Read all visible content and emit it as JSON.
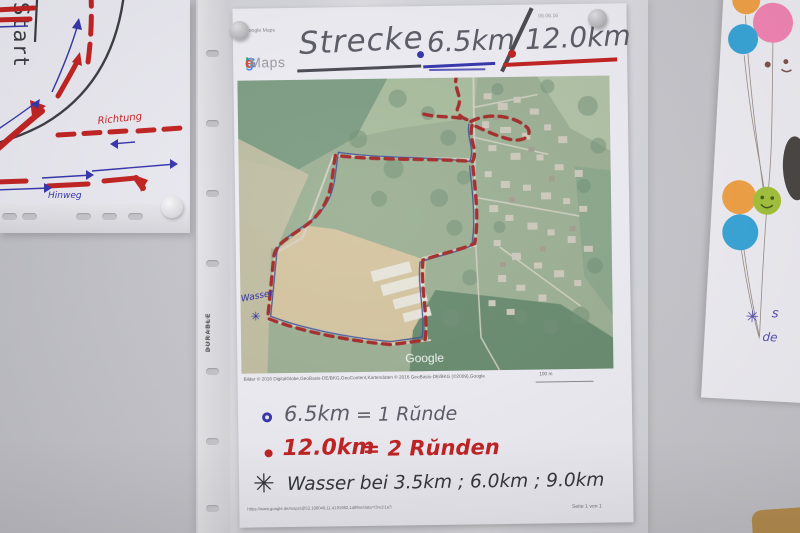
{
  "left_sketch": {
    "start_label": "Start",
    "direction_label": "Richtung",
    "outbound_label": "Hinweg"
  },
  "sleeve": {
    "brand": "DURABLE",
    "origin": "MADE IN GERMANY"
  },
  "page": {
    "header": {
      "app_label": "Google Maps",
      "date_note": "06.06.16"
    },
    "logo": {
      "letters": [
        "G",
        "o",
        "o",
        "g",
        "l",
        "e"
      ],
      "maps": "Maps"
    },
    "title": {
      "word": "Strecke",
      "short_distance": "6.5km",
      "separator": "/",
      "long_distance": "12.0km"
    },
    "map": {
      "watermark": "Google",
      "water_label": "Wasser",
      "water_asterisk": "✳",
      "attribution": "Bilder © 2016 DigitalGlobe,GeoBasis-DE/BKG,GeoContent,Kartendaten © 2016 GeoBasis-DE/BKG (©2009),Google",
      "scale_label": "100 m"
    },
    "notes": [
      {
        "distance": "6.5km",
        "rounds": "= 1 Rŭnde"
      },
      {
        "distance": "12.0km",
        "rounds": "= 2 Rŭnden"
      },
      {
        "asterisk": "✳",
        "text": "Wasser bei 3.5km ; 6.0km ; 9.0km"
      }
    ],
    "footer": {
      "url": "https://www.google.de/maps/@52.198046,11.4191982,1489m/data=!3m1!1e3",
      "page_label": "Seite 1 von 1"
    }
  },
  "right_art": {
    "asterisk": "✳",
    "partial_text_a": "s",
    "partial_text_b": "de"
  },
  "colors": {
    "route_red": "#b02828",
    "route_blue": "#3a4f9e",
    "marker_red": "#c32222",
    "marker_blue": "#3535ae",
    "pencil_grey": "#5c5c68",
    "ink_dark": "#35353d",
    "balloon_orange": "#f4a447",
    "balloon_pink": "#f787b7",
    "balloon_blue": "#39a8dc",
    "balloon_green": "#a6c63c"
  }
}
